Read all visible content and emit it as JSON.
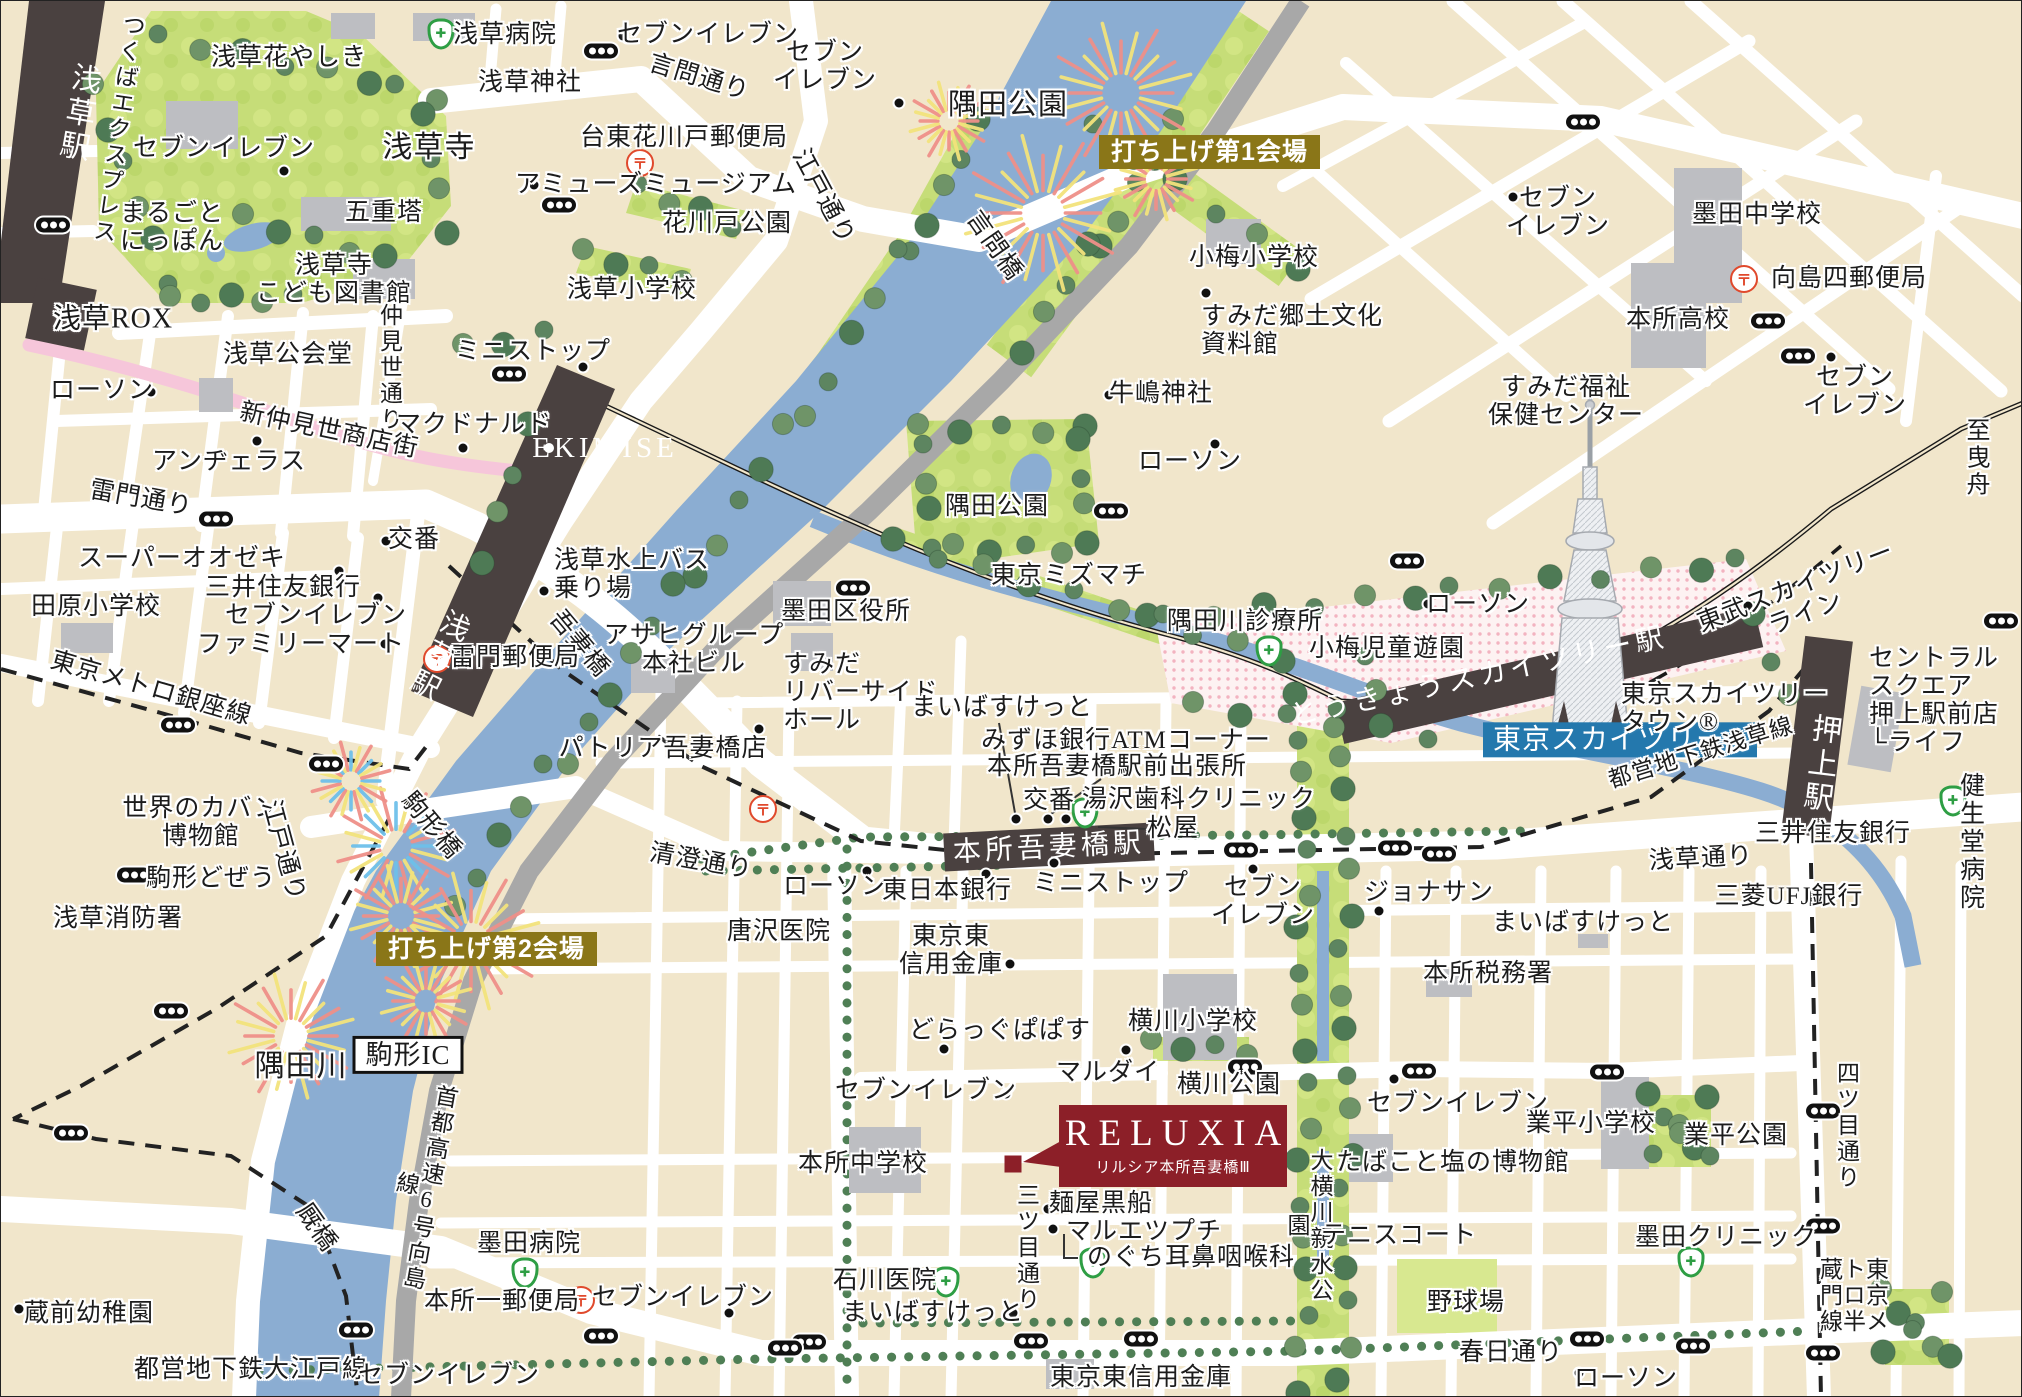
{
  "map": {
    "reluxia": {
      "brand": "RELUXIA",
      "name": "リルシア本所吾妻橋Ⅲ"
    },
    "colors": {
      "accent_red": "#8c1f28",
      "badge_gold": "#8a7618",
      "badge_blue": "#2478ad",
      "river": "#8badd2",
      "park": "#c6dd78",
      "rail_band": "#4a4140"
    },
    "labels": [
      {
        "t": "浅草駅",
        "x": 76,
        "y": 112,
        "r": 10,
        "c": "v dark",
        "s": 30
      },
      {
        "t": "つくばエクスプレス",
        "x": 116,
        "y": 128,
        "r": 8,
        "c": "v",
        "s": 23
      },
      {
        "t": "浅草花やしき",
        "x": 288,
        "y": 57
      },
      {
        "t": "浅草病院",
        "x": 504,
        "y": 34
      },
      {
        "t": "セブンイレブン",
        "x": 223,
        "y": 148
      },
      {
        "t": "まるごと\nにっぽん",
        "x": 171,
        "y": 227
      },
      {
        "t": "五重塔",
        "x": 383,
        "y": 212
      },
      {
        "t": "浅草寺",
        "x": 428,
        "y": 147,
        "s": 30
      },
      {
        "t": "浅草寺\nこども図書館",
        "x": 333,
        "y": 279
      },
      {
        "t": "セブンイレブン",
        "x": 707,
        "y": 34
      },
      {
        "t": "言問通り",
        "x": 698,
        "y": 77,
        "r": 17
      },
      {
        "t": "セブン\nイレブン",
        "x": 824,
        "y": 66
      },
      {
        "t": "浅草神社",
        "x": 529,
        "y": 82
      },
      {
        "t": "台東花川戸郵便局",
        "x": 683,
        "y": 137
      },
      {
        "t": "アミューズミュージアム",
        "x": 655,
        "y": 184
      },
      {
        "t": "花川戸公園",
        "x": 726,
        "y": 223
      },
      {
        "t": "浅草小学校",
        "x": 631,
        "y": 289
      },
      {
        "t": "江戸通り",
        "x": 822,
        "y": 196,
        "r": 62
      },
      {
        "t": "隅田公園",
        "x": 1007,
        "y": 104,
        "s": 29
      },
      {
        "t": "言問橋",
        "x": 993,
        "y": 245,
        "r": 55
      },
      {
        "t": "小梅小学校",
        "x": 1253,
        "y": 257
      },
      {
        "t": "すみだ郷土文化\n資料館",
        "x": 1200,
        "y": 330,
        "c": "l"
      },
      {
        "t": "墨田中学校",
        "x": 1756,
        "y": 214
      },
      {
        "t": "向島四郵便局",
        "x": 1848,
        "y": 278
      },
      {
        "t": "本所高校",
        "x": 1677,
        "y": 319
      },
      {
        "t": "セブン\nイレブン",
        "x": 1557,
        "y": 212
      },
      {
        "t": "すみだ福祉\n保健センター",
        "x": 1565,
        "y": 401
      },
      {
        "t": "セブン\nイレブン",
        "x": 1854,
        "y": 391
      },
      {
        "t": "至 曳舟",
        "x": 1978,
        "y": 458,
        "s": 24
      },
      {
        "t": "東武スカイツリーライン",
        "x": 1800,
        "y": 600,
        "r": -21
      },
      {
        "t": "浅草ROX",
        "x": 112,
        "y": 318,
        "s": 28
      },
      {
        "t": "ローソン",
        "x": 101,
        "y": 390
      },
      {
        "t": "新仲見世商店街",
        "x": 328,
        "y": 430,
        "r": 12
      },
      {
        "t": "アンヂェラス",
        "x": 228,
        "y": 461
      },
      {
        "t": "雷門通り",
        "x": 140,
        "y": 498,
        "r": 10
      },
      {
        "t": "スーパーオオゼキ",
        "x": 181,
        "y": 558
      },
      {
        "t": "三井住友銀行",
        "x": 282,
        "y": 587
      },
      {
        "t": "セブンイレブン",
        "x": 315,
        "y": 615
      },
      {
        "t": "ファミリーマート",
        "x": 300,
        "y": 644
      },
      {
        "t": "田原小学校",
        "x": 95,
        "y": 606
      },
      {
        "t": "東京メトロ銀座線",
        "x": 150,
        "y": 688,
        "r": 16
      },
      {
        "t": "仲見世通り",
        "x": 388,
        "y": 367,
        "c": "v",
        "s": 23
      },
      {
        "t": "浅草公会堂",
        "x": 287,
        "y": 354
      },
      {
        "t": "マクドナルド",
        "x": 473,
        "y": 424
      },
      {
        "t": "ミニストップ",
        "x": 532,
        "y": 351
      },
      {
        "t": "EKIMISE",
        "x": 604,
        "y": 447,
        "c": "dark",
        "s": 29
      },
      {
        "t": "交番",
        "x": 413,
        "y": 539
      },
      {
        "t": "浅草水上バス\n乗り場",
        "x": 553,
        "y": 574,
        "c": "l"
      },
      {
        "t": "吾妻橋",
        "x": 578,
        "y": 643,
        "r": 50
      },
      {
        "t": "アサヒグループ\n本社ビル",
        "x": 693,
        "y": 649
      },
      {
        "t": "雷門郵便局",
        "x": 514,
        "y": 657
      },
      {
        "t": "浅草駅",
        "x": 436,
        "y": 654,
        "r": 27,
        "c": "v dark",
        "s": 29
      },
      {
        "t": "墨田区役所",
        "x": 845,
        "y": 611
      },
      {
        "t": "すみだ\nリバーサイド\nホール",
        "x": 782,
        "y": 692,
        "c": "l"
      },
      {
        "t": "パトリア吾妻橋店",
        "x": 662,
        "y": 748
      },
      {
        "t": "東京ミズマチ",
        "x": 1068,
        "y": 575
      },
      {
        "t": "隅田公園",
        "x": 996,
        "y": 506
      },
      {
        "t": "牛嶋神社",
        "x": 1160,
        "y": 393
      },
      {
        "t": "ローソン",
        "x": 1189,
        "y": 461
      },
      {
        "t": "隅田川診療所",
        "x": 1244,
        "y": 621
      },
      {
        "t": "小梅児童遊園",
        "x": 1386,
        "y": 648
      },
      {
        "t": "ローソン",
        "x": 1477,
        "y": 604
      },
      {
        "t": "とうきょうスカイツリー駅",
        "x": 1478,
        "y": 676,
        "r": -12,
        "c": "dark",
        "s": 28
      },
      {
        "t": "東京スカイツリー®",
        "x": 1482,
        "y": 739,
        "c": "blue",
        "s": 28
      },
      {
        "t": "東京スカイツリー\nタウン®",
        "x": 1620,
        "y": 708,
        "c": "l"
      },
      {
        "t": "都営地下鉄浅草線",
        "x": 1700,
        "y": 752,
        "r": -17,
        "s": 23
      },
      {
        "t": "押上駅",
        "x": 1818,
        "y": 763,
        "r": 7,
        "c": "v dark",
        "s": 30
      },
      {
        "t": "セントラル\nスクエア\n押上駅前店\n└ライフ",
        "x": 1868,
        "y": 700,
        "c": "l"
      },
      {
        "t": "健生堂\n病院",
        "x": 1972,
        "y": 842
      },
      {
        "t": "三井住友銀行",
        "x": 1832,
        "y": 833
      },
      {
        "t": "三菱UFJ銀行",
        "x": 1788,
        "y": 896
      },
      {
        "t": "浅草通り",
        "x": 1700,
        "y": 858,
        "r": -3
      },
      {
        "t": "まいばすけっと",
        "x": 1001,
        "y": 707
      },
      {
        "t": "みずほ銀行ATMコーナー",
        "x": 1125,
        "y": 740
      },
      {
        "t": "本所吾妻橋駅前出張所",
        "x": 1116,
        "y": 766
      },
      {
        "t": "交番",
        "x": 1048,
        "y": 800
      },
      {
        "t": "湯沢歯科クリニック",
        "x": 1198,
        "y": 799
      },
      {
        "t": "松屋",
        "x": 1172,
        "y": 828
      },
      {
        "t": "本所吾妻橋駅",
        "x": 1048,
        "y": 847,
        "r": -3,
        "c": "dark",
        "s": 28
      },
      {
        "t": "ミニストップ",
        "x": 1110,
        "y": 883
      },
      {
        "t": "セブン\nイレブン",
        "x": 1262,
        "y": 901
      },
      {
        "t": "ジョナサン",
        "x": 1428,
        "y": 892
      },
      {
        "t": "まいばすけっと",
        "x": 1582,
        "y": 922
      },
      {
        "t": "本所税務署",
        "x": 1487,
        "y": 973
      },
      {
        "t": "ローソン",
        "x": 834,
        "y": 886
      },
      {
        "t": "東日本銀行",
        "x": 946,
        "y": 890
      },
      {
        "t": "唐沢医院",
        "x": 778,
        "y": 931
      },
      {
        "t": "東京東\n信用金庫",
        "x": 950,
        "y": 950
      },
      {
        "t": "清澄通り",
        "x": 700,
        "y": 861,
        "r": 10
      },
      {
        "t": "どらっぐぱぱす",
        "x": 999,
        "y": 1030
      },
      {
        "t": "セブンイレブン",
        "x": 925,
        "y": 1090
      },
      {
        "t": "マルダイ",
        "x": 1107,
        "y": 1072
      },
      {
        "t": "横川小学校",
        "x": 1192,
        "y": 1021
      },
      {
        "t": "横川公園",
        "x": 1228,
        "y": 1084
      },
      {
        "t": "世界のカバン\n博物館",
        "x": 200,
        "y": 822
      },
      {
        "t": "駒形どぜう",
        "x": 210,
        "y": 878
      },
      {
        "t": "浅草消防署",
        "x": 117,
        "y": 918
      },
      {
        "t": "江戸通り",
        "x": 282,
        "y": 850,
        "r": 75
      },
      {
        "t": "打ち上げ第2会場",
        "x": 375,
        "y": 948,
        "c": "gold"
      },
      {
        "t": "打ち上げ第1会場",
        "x": 1098,
        "y": 151,
        "c": "gold"
      },
      {
        "t": "隅田川",
        "x": 300,
        "y": 1066,
        "s": 30
      },
      {
        "t": "駒形IC",
        "x": 407,
        "y": 1054,
        "c": "box",
        "s": 27
      },
      {
        "t": "首都高速6号向島線",
        "x": 416,
        "y": 1185,
        "r": 10,
        "c": "v",
        "s": 23
      },
      {
        "t": "駒形橋",
        "x": 430,
        "y": 825,
        "r": 50
      },
      {
        "t": "厩橋",
        "x": 315,
        "y": 1227,
        "r": 55
      },
      {
        "t": "蔵前幼稚園",
        "x": 88,
        "y": 1313
      },
      {
        "t": "都営地下鉄大江戸線",
        "x": 250,
        "y": 1369
      },
      {
        "t": "セブンイレブン",
        "x": 448,
        "y": 1375
      },
      {
        "t": "墨田病院",
        "x": 528,
        "y": 1243
      },
      {
        "t": "本所一郵便局",
        "x": 501,
        "y": 1301
      },
      {
        "t": "セブンイレブン",
        "x": 682,
        "y": 1297
      },
      {
        "t": "石川医院",
        "x": 884,
        "y": 1280
      },
      {
        "t": "まいばすけっと",
        "x": 932,
        "y": 1312
      },
      {
        "t": "三ツ目通り",
        "x": 1025,
        "y": 1247,
        "c": "v",
        "s": 23
      },
      {
        "t": "本所中学校",
        "x": 862,
        "y": 1163
      },
      {
        "t": "麺屋黒船",
        "x": 1100,
        "y": 1203
      },
      {
        "t": "マルエツプチ",
        "x": 1143,
        "y": 1231
      },
      {
        "t": "のぐち耳鼻咽喉科",
        "x": 1190,
        "y": 1257
      },
      {
        "t": "東京東信用金庫",
        "x": 1140,
        "y": 1377
      },
      {
        "t": "大横川親水公園",
        "x": 1307,
        "y": 1225,
        "c": "v",
        "s": 23
      },
      {
        "t": "たばこと塩の博物館",
        "x": 1452,
        "y": 1162
      },
      {
        "t": "セブンイレブン",
        "x": 1457,
        "y": 1103
      },
      {
        "t": "業平小学校",
        "x": 1590,
        "y": 1123
      },
      {
        "t": "業平公園",
        "x": 1735,
        "y": 1135
      },
      {
        "t": "テニスコート",
        "x": 1398,
        "y": 1235
      },
      {
        "t": "墨田クリニック",
        "x": 1725,
        "y": 1237
      },
      {
        "t": "野球場",
        "x": 1465,
        "y": 1302
      },
      {
        "t": "春日通り",
        "x": 1510,
        "y": 1352
      },
      {
        "t": "ローソン",
        "x": 1625,
        "y": 1378
      },
      {
        "t": "四ツ目通り",
        "x": 1845,
        "y": 1125,
        "c": "v",
        "s": 23
      },
      {
        "t": "東京メトロ半蔵門線",
        "x": 1851,
        "y": 1295,
        "c": "v",
        "s": 23
      }
    ],
    "icons": [
      {
        "k": "signal",
        "x": 52,
        "y": 224
      },
      {
        "k": "signal",
        "x": 600,
        "y": 50
      },
      {
        "k": "signal",
        "x": 558,
        "y": 204
      },
      {
        "k": "signal",
        "x": 1582,
        "y": 121
      },
      {
        "k": "signal",
        "x": 1767,
        "y": 320
      },
      {
        "k": "signal",
        "x": 1797,
        "y": 355
      },
      {
        "k": "signal",
        "x": 1110,
        "y": 510
      },
      {
        "k": "signal",
        "x": 1406,
        "y": 560
      },
      {
        "k": "signal",
        "x": 2000,
        "y": 620
      },
      {
        "k": "signal",
        "x": 852,
        "y": 587
      },
      {
        "k": "signal",
        "x": 508,
        "y": 373
      },
      {
        "k": "signal",
        "x": 215,
        "y": 518
      },
      {
        "k": "signal",
        "x": 133,
        "y": 874
      },
      {
        "k": "signal",
        "x": 177,
        "y": 724
      },
      {
        "k": "signal",
        "x": 325,
        "y": 763
      },
      {
        "k": "signal",
        "x": 170,
        "y": 1010
      },
      {
        "k": "signal",
        "x": 70,
        "y": 1132
      },
      {
        "k": "signal",
        "x": 355,
        "y": 1329
      },
      {
        "k": "signal",
        "x": 1240,
        "y": 849
      },
      {
        "k": "signal",
        "x": 1394,
        "y": 847
      },
      {
        "k": "signal",
        "x": 1438,
        "y": 853
      },
      {
        "k": "signal",
        "x": 1244,
        "y": 1066
      },
      {
        "k": "signal",
        "x": 1418,
        "y": 1070
      },
      {
        "k": "signal",
        "x": 1606,
        "y": 1071
      },
      {
        "k": "signal",
        "x": 808,
        "y": 1341
      },
      {
        "k": "signal",
        "x": 1030,
        "y": 1340
      },
      {
        "k": "signal",
        "x": 1140,
        "y": 1338
      },
      {
        "k": "signal",
        "x": 1586,
        "y": 1338
      },
      {
        "k": "signal",
        "x": 1692,
        "y": 1345
      },
      {
        "k": "signal",
        "x": 600,
        "y": 1335
      },
      {
        "k": "signal",
        "x": 784,
        "y": 1347
      },
      {
        "k": "signal",
        "x": 1822,
        "y": 1110
      },
      {
        "k": "signal",
        "x": 1822,
        "y": 1225
      },
      {
        "k": "signal",
        "x": 1822,
        "y": 1352
      },
      {
        "k": "post",
        "x": 639,
        "y": 162
      },
      {
        "k": "post",
        "x": 1743,
        "y": 278
      },
      {
        "k": "post",
        "x": 436,
        "y": 658
      },
      {
        "k": "post",
        "x": 762,
        "y": 808
      },
      {
        "k": "post",
        "x": 580,
        "y": 1299
      },
      {
        "k": "med",
        "x": 440,
        "y": 33
      },
      {
        "k": "med",
        "x": 1268,
        "y": 650
      },
      {
        "k": "med",
        "x": 1084,
        "y": 812
      },
      {
        "k": "med",
        "x": 1952,
        "y": 800
      },
      {
        "k": "med",
        "x": 945,
        "y": 1281
      },
      {
        "k": "med",
        "x": 524,
        "y": 1272
      },
      {
        "k": "med",
        "x": 1092,
        "y": 1262
      },
      {
        "k": "med",
        "x": 1690,
        "y": 1261
      },
      {
        "k": "dot",
        "x": 283,
        "y": 170
      },
      {
        "k": "dot",
        "x": 622,
        "y": 35
      },
      {
        "k": "dot",
        "x": 898,
        "y": 102
      },
      {
        "k": "dot",
        "x": 533,
        "y": 184
      },
      {
        "k": "dot",
        "x": 1205,
        "y": 292
      },
      {
        "k": "dot",
        "x": 1512,
        "y": 196
      },
      {
        "k": "dot",
        "x": 1830,
        "y": 356
      },
      {
        "k": "dot",
        "x": 1747,
        "y": 605
      },
      {
        "k": "dot",
        "x": 1427,
        "y": 603
      },
      {
        "k": "dot",
        "x": 1214,
        "y": 443
      },
      {
        "k": "dot",
        "x": 1108,
        "y": 394
      },
      {
        "k": "dot",
        "x": 150,
        "y": 391
      },
      {
        "k": "dot",
        "x": 256,
        "y": 440
      },
      {
        "k": "dot",
        "x": 275,
        "y": 556
      },
      {
        "k": "dot",
        "x": 338,
        "y": 570
      },
      {
        "k": "dot",
        "x": 377,
        "y": 597
      },
      {
        "k": "dot",
        "x": 384,
        "y": 643
      },
      {
        "k": "dot",
        "x": 385,
        "y": 540
      },
      {
        "k": "dot",
        "x": 582,
        "y": 366
      },
      {
        "k": "dot",
        "x": 462,
        "y": 447
      },
      {
        "k": "dot",
        "x": 543,
        "y": 590
      },
      {
        "k": "dot",
        "x": 758,
        "y": 728
      },
      {
        "k": "dot",
        "x": 866,
        "y": 870
      },
      {
        "k": "dot",
        "x": 985,
        "y": 873
      },
      {
        "k": "dot",
        "x": 1009,
        "y": 963
      },
      {
        "k": "dot",
        "x": 943,
        "y": 1048
      },
      {
        "k": "dot",
        "x": 1005,
        "y": 1093
      },
      {
        "k": "dot",
        "x": 1125,
        "y": 1049
      },
      {
        "k": "dot",
        "x": 1378,
        "y": 910
      },
      {
        "k": "dot",
        "x": 1393,
        "y": 1078
      },
      {
        "k": "dot",
        "x": 1252,
        "y": 868
      },
      {
        "k": "dot",
        "x": 1053,
        "y": 862
      },
      {
        "k": "dot",
        "x": 1578,
        "y": 1372
      },
      {
        "k": "dot",
        "x": 18,
        "y": 1308
      },
      {
        "k": "dot",
        "x": 373,
        "y": 1370
      },
      {
        "k": "dot",
        "x": 728,
        "y": 1312
      },
      {
        "k": "dot",
        "x": 1012,
        "y": 1312
      },
      {
        "k": "dot",
        "x": 1052,
        "y": 1228
      },
      {
        "k": "dot",
        "x": 1047,
        "y": 1208
      },
      {
        "k": "dot",
        "x": 1015,
        "y": 818
      },
      {
        "k": "dot",
        "x": 1047,
        "y": 818
      },
      {
        "k": "dot",
        "x": 1065,
        "y": 818
      },
      {
        "k": "wdot",
        "x": 548,
        "y": 447
      },
      {
        "k": "marker",
        "x": 1012,
        "y": 1163
      }
    ]
  }
}
